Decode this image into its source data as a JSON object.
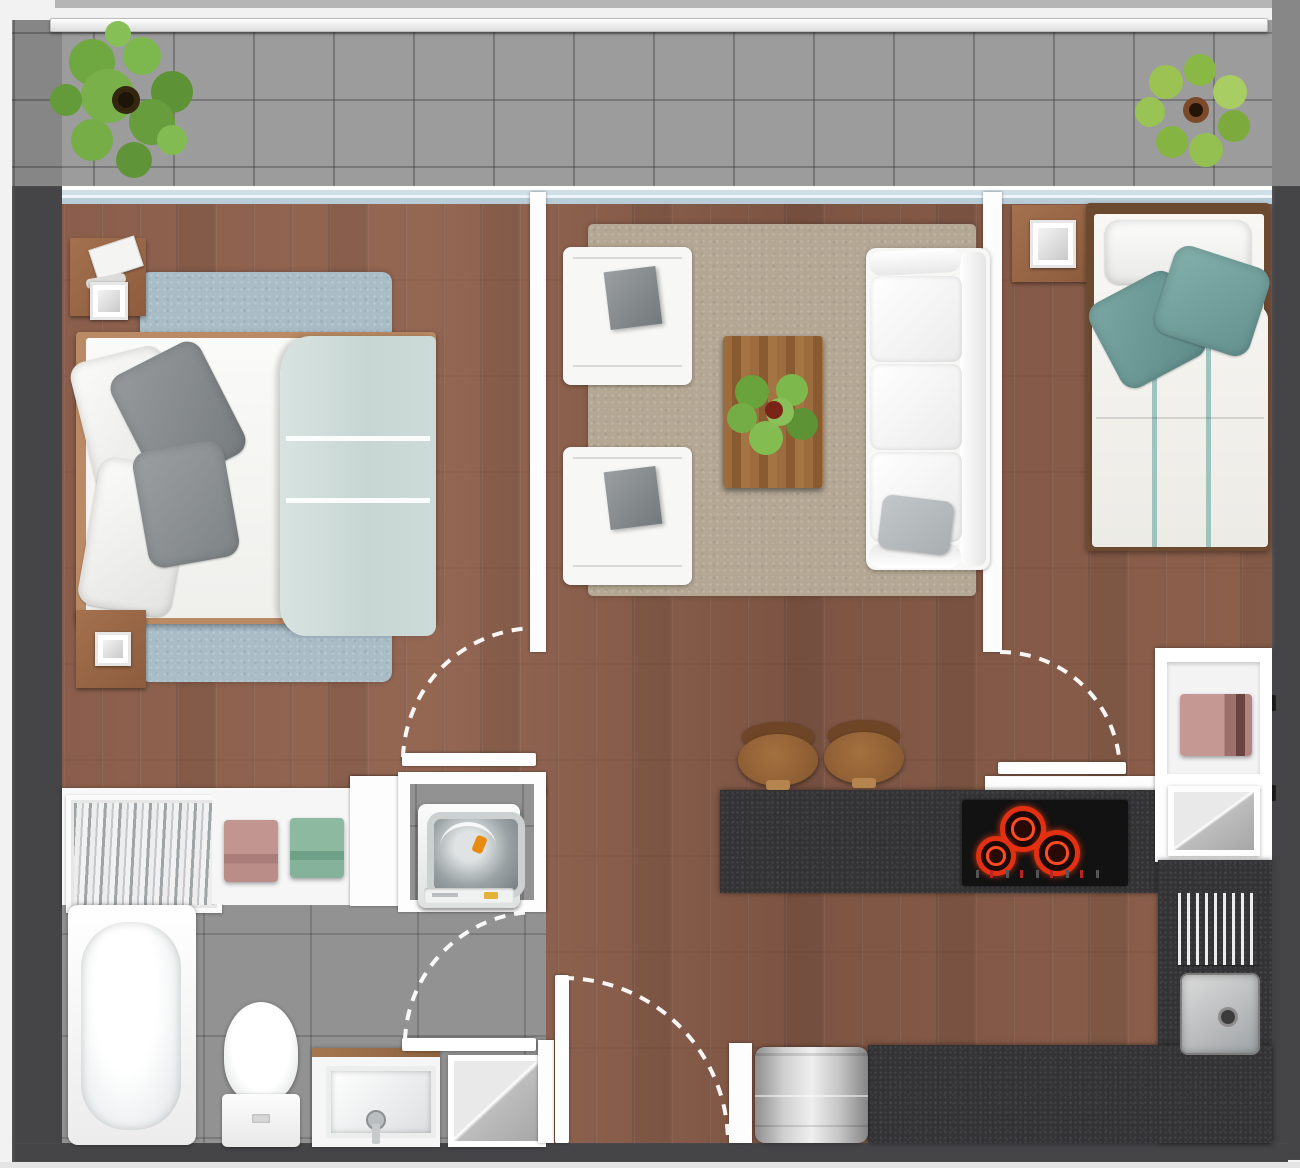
{
  "title": "apartment-floor-plan-top-view",
  "palette": {
    "wall_dark": "#454548",
    "wall_white": "#fdfdfd",
    "wood_floor": "#8a5e4b",
    "balcony_tile": "#9c9c9c",
    "bath_tile": "#929292",
    "counter_dark": "#333335",
    "rug_blue": "#a9bdc7",
    "rug_beige": "#b4a794",
    "duvet_blue": "#cfdcd9",
    "pillow_teal": "#6f9d9b",
    "plant_green": "#6fa741",
    "burner_red": "#e23012",
    "towel_pink": "#b98b87",
    "towel_green": "#7fae94",
    "stool_brown": "#8a5a31"
  },
  "balcony": {
    "railing": "white-railing",
    "floor": "gray-tile-grid",
    "plants": [
      "potted-plant-left",
      "potted-plant-right"
    ],
    "sliding_door": "full-width-glass-slider"
  },
  "rooms": [
    {
      "name": "bedroom-1",
      "position": "top-left",
      "furniture": [
        "double-bed",
        "white-pillows",
        "gray-pillows",
        "light-blue-duvet",
        "blue-shag-rug",
        "nightstand-top",
        "nightstand-bottom",
        "square-lamp-top",
        "square-lamp-bottom",
        "papers-on-nightstand"
      ]
    },
    {
      "name": "living-room",
      "position": "top-center",
      "furniture": [
        "armchair-top",
        "armchair-bottom",
        "wood-coffee-table",
        "table-plant",
        "three-seat-sofa",
        "beige-rug"
      ]
    },
    {
      "name": "bedroom-2",
      "position": "top-right",
      "furniture": [
        "single-bed",
        "white-pillow",
        "teal-pillows",
        "striped-duvet",
        "nightstand",
        "square-lamp"
      ]
    },
    {
      "name": "bathroom-laundry",
      "position": "bottom-left",
      "furniture": [
        "slatted-closet",
        "towel-shelf",
        "pink-towel",
        "green-towel",
        "top-load-washing-machine",
        "bathtub",
        "toilet",
        "vanity-sink",
        "shower-tray"
      ]
    },
    {
      "name": "kitchen",
      "position": "bottom-right",
      "furniture": [
        "island-counter",
        "cooktop-three-burners",
        "bar-stool-1",
        "bar-stool-2",
        "hall-closet-pink-towel",
        "mirror-shelf",
        "dish-rack",
        "square-sink",
        "l-shaped-counter",
        "stainless-refrigerator"
      ]
    }
  ],
  "doors": [
    {
      "name": "bedroom-1-door",
      "type": "swing",
      "arc": "dashed"
    },
    {
      "name": "bathroom-door",
      "type": "swing",
      "arc": "dashed"
    },
    {
      "name": "bedroom-2-door",
      "type": "swing",
      "arc": "dashed"
    },
    {
      "name": "entry-door",
      "type": "swing",
      "arc": "dashed"
    }
  ]
}
